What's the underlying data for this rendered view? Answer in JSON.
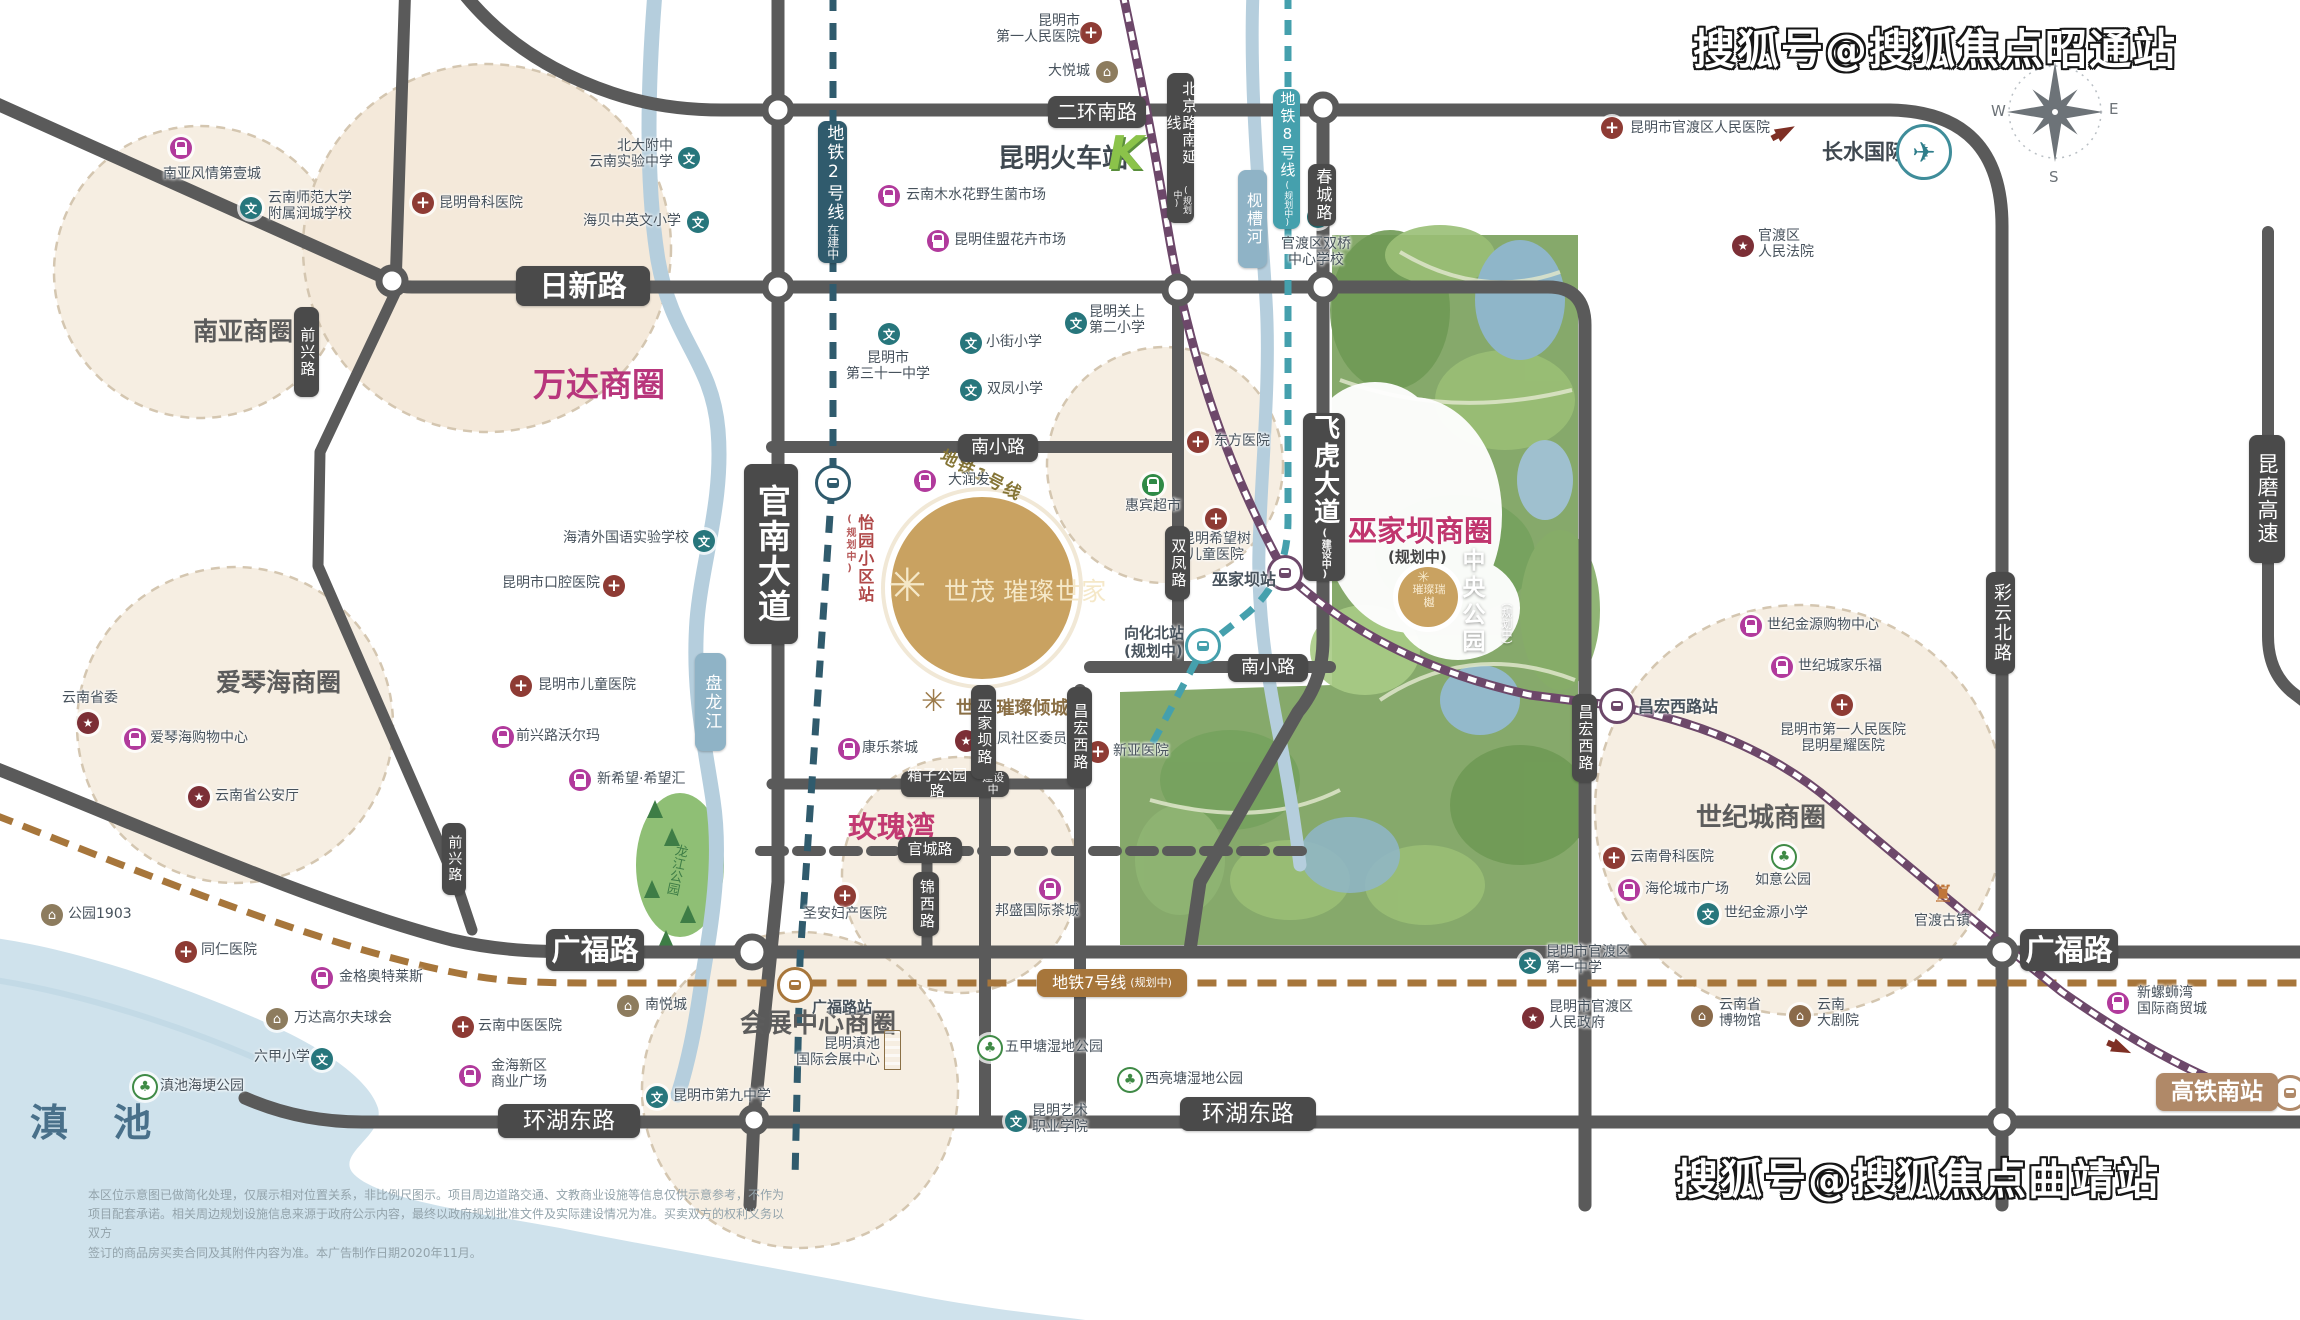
{
  "watermark_top": "搜狐号@搜狐焦点昭通站",
  "watermark_bottom": "搜狐号@搜狐焦点曲靖站",
  "lake_label": "滇 池",
  "compass": {
    "w": "W",
    "e": "E",
    "s": "S"
  },
  "airport": {
    "name": "长水国际机场"
  },
  "kstation": {
    "name": "昆明火车站",
    "logo": "K"
  },
  "project": {
    "flower": "✳",
    "main": "世茂 璀璨世家",
    "sub": "世茂 璀璨倾城",
    "small": "璀璨瑞樾"
  },
  "central_park": {
    "name": "中央公园",
    "status": "（规划中）"
  },
  "wujiaba": {
    "name": "巫家坝商圈",
    "status": "(规划中)"
  },
  "line1_label": "地铁1号线",
  "longjiang_park": "龙江公园",
  "disclaimer": {
    "l1": "本区位示意图已做简化处理，仅展示相对位置关系，非比例尺图示。项目周边道路交通、文教商业设施等信息仅供示意参考，不作为",
    "l2": "项目配套承诺。相关周边规划设施信息来源于政府公示内容，最终以政府规划批准文件及实际建设情况为准。买卖双方的权利义务以双方",
    "l3": "签订的商品房买卖合同及其附件内容为准。本广告制作日期2020年11月。"
  },
  "pills": [
    {
      "t": "日新路",
      "x": 516,
      "y": 266,
      "w": 134,
      "h": 40,
      "fs": 29,
      "bold": 1
    },
    {
      "t": "二环南路",
      "x": 1048,
      "y": 96,
      "w": 98,
      "h": 32,
      "fs": 20
    },
    {
      "t": "广福路",
      "x": 546,
      "y": 929,
      "w": 98,
      "h": 42,
      "fs": 29,
      "bold": 1
    },
    {
      "t": "广福路",
      "x": 2020,
      "y": 929,
      "w": 98,
      "h": 42,
      "fs": 29,
      "bold": 1
    },
    {
      "t": "环湖东路",
      "x": 498,
      "y": 1104,
      "w": 142,
      "h": 34,
      "fs": 23
    },
    {
      "t": "环湖东路",
      "x": 1180,
      "y": 1097,
      "w": 136,
      "h": 34,
      "fs": 23
    },
    {
      "t": "南小路",
      "x": 958,
      "y": 434,
      "w": 80,
      "h": 28,
      "fs": 18
    },
    {
      "t": "南小路",
      "x": 1228,
      "y": 654,
      "w": 80,
      "h": 28,
      "fs": 18
    },
    {
      "t": "箱子公园路",
      "x": 901,
      "y": 771,
      "w": 108,
      "h": 26,
      "fs": 15,
      "sub2": "建设中"
    },
    {
      "t": "官城路",
      "x": 898,
      "y": 837,
      "w": 64,
      "h": 26,
      "fs": 15
    },
    {
      "t": "锦西路",
      "x": 913,
      "y": 872,
      "w": 26,
      "h": 64,
      "fs": 15,
      "v": 1
    },
    {
      "t": "官南大道",
      "x": 744,
      "y": 464,
      "w": 54,
      "h": 180,
      "fs": 33,
      "v": 1,
      "bold": 1
    },
    {
      "t": "飞虎大道",
      "x": 1303,
      "y": 413,
      "w": 42,
      "h": 168,
      "fs": 26,
      "v": 1,
      "bold": 1,
      "sub": "(建设中)",
      "subFs": 10
    },
    {
      "t": "双凤路",
      "x": 1165,
      "y": 526,
      "w": 25,
      "h": 74,
      "fs": 15,
      "v": 1
    },
    {
      "t": "巫家坝路",
      "x": 971,
      "y": 685,
      "w": 25,
      "h": 94,
      "fs": 15,
      "v": 1
    },
    {
      "t": "昌宏西路",
      "x": 1067,
      "y": 687,
      "w": 25,
      "h": 100,
      "fs": 15,
      "v": 1
    },
    {
      "t": "昌宏西路",
      "x": 1572,
      "y": 694,
      "w": 25,
      "h": 88,
      "fs": 15,
      "v": 1
    },
    {
      "t": "彩云北路",
      "x": 1986,
      "y": 572,
      "w": 29,
      "h": 102,
      "fs": 18,
      "v": 1
    },
    {
      "t": "前兴路",
      "x": 294,
      "y": 307,
      "w": 25,
      "h": 90,
      "fs": 15,
      "v": 1
    },
    {
      "t": "前兴路",
      "x": 442,
      "y": 823,
      "w": 24,
      "h": 72,
      "fs": 14,
      "v": 1
    },
    {
      "t": "春城路",
      "x": 1308,
      "y": 164,
      "w": 28,
      "h": 62,
      "fs": 16,
      "v": 1
    },
    {
      "t": "昆磨高速",
      "x": 2249,
      "y": 435,
      "w": 36,
      "h": 128,
      "fs": 21,
      "v": 1
    },
    {
      "t": "北京路南延线",
      "x": 1167,
      "y": 73,
      "w": 27,
      "h": 150,
      "fs": 15,
      "v": 1,
      "sub": "(规划中)",
      "subFs": 9
    },
    {
      "t": "地铁2号线",
      "x": 818,
      "y": 121,
      "w": 29,
      "h": 142,
      "fs": 17,
      "v": 1,
      "bg": "#305b6d",
      "sub": "在建中",
      "subFs": 12
    },
    {
      "t": "地铁8号线",
      "x": 1273,
      "y": 89,
      "w": 27,
      "h": 140,
      "fs": 15,
      "v": 1,
      "bg": "#45a0ad",
      "sub": "(规划中)",
      "subFs": 9
    },
    {
      "t": "地铁7号线",
      "x": 1037,
      "y": 969,
      "w": 150,
      "h": 28,
      "fs": 16,
      "bg": "#a7763b",
      "sub2": "(规划中)"
    },
    {
      "t": "盘龙江",
      "x": 695,
      "y": 653,
      "w": 31,
      "h": 98,
      "fs": 17,
      "v": 1,
      "bg": "#8fb3c6"
    },
    {
      "t": "枧槽河",
      "x": 1238,
      "y": 170,
      "w": 29,
      "h": 98,
      "fs": 16,
      "v": 1,
      "bg": "#8fb3c6"
    },
    {
      "t": "高铁南站",
      "x": 2156,
      "y": 1073,
      "w": 122,
      "h": 38,
      "fs": 23,
      "bg": "#b08968",
      "bold": 1
    }
  ],
  "areas": [
    {
      "t": "南亚商圈",
      "x": 193,
      "y": 312,
      "fs": 25,
      "c": "#5c5c5c"
    },
    {
      "t": "万达商圈",
      "x": 533,
      "y": 358,
      "fs": 33,
      "c": "#b8367c"
    },
    {
      "t": "爱琴海商圈",
      "x": 216,
      "y": 663,
      "fs": 25,
      "c": "#5c5c5c"
    },
    {
      "t": "玫瑰湾",
      "x": 848,
      "y": 804,
      "fs": 29,
      "c": "#c23a72"
    },
    {
      "t": "世纪城商圈",
      "x": 1696,
      "y": 797,
      "fs": 26,
      "c": "#5c5c5c"
    },
    {
      "t": "会展中心商圈",
      "x": 740,
      "y": 1003,
      "fs": 26,
      "c": "#5c5c5c"
    },
    {
      "t": "昆明火车站",
      "x": 998,
      "y": 138,
      "fs": 26,
      "c": "#3f4850"
    }
  ],
  "pois": [
    {
      "k": "shop",
      "ix": 181,
      "iy": 148,
      "t": "南亚风情第壹城",
      "lx": 163,
      "ly": 166
    },
    {
      "k": "school",
      "ix": 251,
      "iy": 208,
      "t": "云南师范大学\n附属润城学校",
      "lx": 268,
      "ly": 190
    },
    {
      "k": "hospital",
      "ix": 423,
      "iy": 203,
      "t": "昆明骨科医院",
      "lx": 439,
      "ly": 195
    },
    {
      "k": "school",
      "ix": 689,
      "iy": 158,
      "t": "北大附中\n云南实验中学",
      "lx": 673,
      "ly": 138,
      "a": "tr"
    },
    {
      "k": "school",
      "ix": 698,
      "iy": 222,
      "t": "海贝中英文小学",
      "lx": 681,
      "ly": 213,
      "a": "tr"
    },
    {
      "k": "hospital",
      "ix": 1091,
      "iy": 33,
      "t": "昆明市\n第一人民医院",
      "lx": 1080,
      "ly": 13,
      "a": "tr"
    },
    {
      "k": "bldg",
      "ix": 1107,
      "iy": 72,
      "t": "大悦城",
      "lx": 1090,
      "ly": 63,
      "a": "tr"
    },
    {
      "k": "shop",
      "ix": 889,
      "iy": 196,
      "t": "云南木水花野生菌市场",
      "lx": 906,
      "ly": 187
    },
    {
      "k": "shop",
      "ix": 938,
      "iy": 241,
      "t": "昆明佳盟花卉市场",
      "lx": 954,
      "ly": 232
    },
    {
      "k": "hospital",
      "ix": 1612,
      "iy": 128,
      "t": "昆明市官渡区人民医院",
      "lx": 1630,
      "ly": 120
    },
    {
      "k": "gov",
      "ix": 1743,
      "iy": 246,
      "t": "官渡区\n人民法院",
      "lx": 1758,
      "ly": 228
    },
    {
      "k": "school",
      "ix": 1318,
      "iy": 217,
      "t": "官渡区双桥\n中心学校",
      "lx": 1316,
      "ly": 236,
      "a": "tc"
    },
    {
      "k": "school",
      "ix": 889,
      "iy": 334,
      "t": "昆明市\n第三十一中学",
      "lx": 888,
      "ly": 350,
      "a": "tc"
    },
    {
      "k": "school",
      "ix": 971,
      "iy": 343,
      "t": "小街小学",
      "lx": 986,
      "ly": 334
    },
    {
      "k": "school",
      "ix": 971,
      "iy": 390,
      "t": "双凤小学",
      "lx": 987,
      "ly": 381
    },
    {
      "k": "school",
      "ix": 1076,
      "iy": 323,
      "t": "昆明关上\n第二小学",
      "lx": 1089,
      "ly": 304
    },
    {
      "k": "school",
      "ix": 704,
      "iy": 541,
      "t": "海清外国语实验学校",
      "lx": 689,
      "ly": 530,
      "a": "tr"
    },
    {
      "k": "hospital",
      "ix": 614,
      "iy": 586,
      "t": "昆明市口腔医院",
      "lx": 600,
      "ly": 575,
      "a": "tr"
    },
    {
      "k": "hospital",
      "ix": 1198,
      "iy": 442,
      "t": "东方医院",
      "lx": 1214,
      "ly": 433
    },
    {
      "k": "hospital",
      "ix": 1216,
      "iy": 519,
      "t": "昆明希望树\n儿童医院",
      "lx": 1216,
      "ly": 531,
      "a": "tc"
    },
    {
      "k": "shopg",
      "ix": 1153,
      "iy": 485,
      "t": "惠宾超市",
      "lx": 1153,
      "ly": 498,
      "a": "tc"
    },
    {
      "k": "shop",
      "ix": 925,
      "iy": 481,
      "t": "大润发",
      "lx": 948,
      "ly": 472
    },
    {
      "k": "hospital",
      "ix": 521,
      "iy": 686,
      "t": "昆明市儿童医院",
      "lx": 538,
      "ly": 677
    },
    {
      "k": "shop",
      "ix": 503,
      "iy": 737,
      "t": "前兴路沃尔玛",
      "lx": 516,
      "ly": 728
    },
    {
      "k": "shop",
      "ix": 580,
      "iy": 780,
      "t": "新希望·希望汇",
      "lx": 597,
      "ly": 771
    },
    {
      "k": "gov",
      "ix": 966,
      "iy": 741,
      "t": "双凤社区委员会",
      "lx": 983,
      "ly": 731
    },
    {
      "k": "hospital",
      "ix": 1098,
      "iy": 752,
      "t": "新亚医院",
      "lx": 1113,
      "ly": 743
    },
    {
      "k": "shop",
      "ix": 849,
      "iy": 749,
      "t": "康乐茶城",
      "lx": 862,
      "ly": 740
    },
    {
      "k": "hospital",
      "ix": 845,
      "iy": 896,
      "t": "圣安妇产医院",
      "lx": 845,
      "ly": 906,
      "a": "tc"
    },
    {
      "k": "shop",
      "ix": 1050,
      "iy": 889,
      "t": "邦盛国际茶城",
      "lx": 1037,
      "ly": 903,
      "a": "tc"
    },
    {
      "k": "gov",
      "ix": 88,
      "iy": 723,
      "t": "云南省委",
      "lx": 62,
      "ly": 690
    },
    {
      "k": "shop",
      "ix": 135,
      "iy": 739,
      "t": "爱琴海购物中心",
      "lx": 150,
      "ly": 730
    },
    {
      "k": "gov",
      "ix": 199,
      "iy": 797,
      "t": "云南省公安厅",
      "lx": 215,
      "ly": 788
    },
    {
      "k": "bldg",
      "ix": 52,
      "iy": 915,
      "t": "公园1903",
      "lx": 68,
      "ly": 906
    },
    {
      "k": "hospital",
      "ix": 186,
      "iy": 952,
      "t": "同仁医院",
      "lx": 201,
      "ly": 942
    },
    {
      "k": "shop",
      "ix": 322,
      "iy": 978,
      "t": "金格奥特莱斯",
      "lx": 339,
      "ly": 969
    },
    {
      "k": "bldg",
      "ix": 277,
      "iy": 1019,
      "t": "万达高尔夫球会",
      "lx": 294,
      "ly": 1010
    },
    {
      "k": "school",
      "ix": 322,
      "iy": 1059,
      "t": "六甲小学",
      "lx": 310,
      "ly": 1049,
      "a": "tr"
    },
    {
      "k": "park",
      "ix": 145,
      "iy": 1087,
      "t": "滇池海埂公园",
      "lx": 160,
      "ly": 1078
    },
    {
      "k": "hospital",
      "ix": 463,
      "iy": 1027,
      "t": "云南中医医院",
      "lx": 478,
      "ly": 1018
    },
    {
      "k": "shop",
      "ix": 470,
      "iy": 1076,
      "t": "金海新区\n商业广场",
      "lx": 491,
      "ly": 1058
    },
    {
      "k": "bldg",
      "ix": 628,
      "iy": 1006,
      "t": "南悦城",
      "lx": 645,
      "ly": 997
    },
    {
      "k": "school",
      "ix": 657,
      "iy": 1097,
      "t": "昆明市第九中学",
      "lx": 673,
      "ly": 1088
    },
    {
      "k": "expo",
      "ix": 884,
      "iy": 1036,
      "t": "昆明滇池\n国际会展中心",
      "lx": 880,
      "ly": 1036,
      "a": "tr"
    },
    {
      "k": "park",
      "ix": 990,
      "iy": 1048,
      "t": "五甲塘湿地公园",
      "lx": 1005,
      "ly": 1039
    },
    {
      "k": "park",
      "ix": 1130,
      "iy": 1080,
      "t": "西亮塘湿地公园",
      "lx": 1145,
      "ly": 1071
    },
    {
      "k": "school",
      "ix": 1016,
      "iy": 1121,
      "t": "昆明艺术\n职业学院",
      "lx": 1032,
      "ly": 1103
    },
    {
      "k": "school",
      "ix": 1530,
      "iy": 963,
      "t": "昆明市官渡区\n第一中学",
      "lx": 1546,
      "ly": 944
    },
    {
      "k": "gov",
      "ix": 1533,
      "iy": 1018,
      "t": "昆明市官渡区\n人民政府",
      "lx": 1549,
      "ly": 999
    },
    {
      "k": "museum",
      "ix": 1702,
      "iy": 1016,
      "t": "云南省\n博物馆",
      "lx": 1719,
      "ly": 997
    },
    {
      "k": "museum",
      "ix": 1800,
      "iy": 1016,
      "t": "云南\n大剧院",
      "lx": 1817,
      "ly": 997
    },
    {
      "k": "hospital",
      "ix": 1842,
      "iy": 705,
      "t": "昆明市第一人民医院\n昆明星耀医院",
      "lx": 1843,
      "ly": 722,
      "a": "tc"
    },
    {
      "k": "shop",
      "ix": 1751,
      "iy": 626,
      "t": "世纪金源购物中心",
      "lx": 1767,
      "ly": 617
    },
    {
      "k": "shop",
      "ix": 1782,
      "iy": 667,
      "t": "世纪城家乐福",
      "lx": 1798,
      "ly": 658
    },
    {
      "k": "hospital",
      "ix": 1614,
      "iy": 858,
      "t": "云南骨科医院",
      "lx": 1630,
      "ly": 849
    },
    {
      "k": "shop",
      "ix": 1629,
      "iy": 890,
      "t": "海伦城市广场",
      "lx": 1645,
      "ly": 881
    },
    {
      "k": "park",
      "ix": 1784,
      "iy": 857,
      "t": "如意公园",
      "lx": 1783,
      "ly": 872,
      "a": "tc"
    },
    {
      "k": "school",
      "ix": 1708,
      "iy": 914,
      "t": "世纪金源小学",
      "lx": 1724,
      "ly": 905
    },
    {
      "k": "temple",
      "ix": 1943,
      "iy": 894,
      "t": "官渡古镇",
      "lx": 1942,
      "ly": 913,
      "a": "tc"
    },
    {
      "k": "shop",
      "ix": 2118,
      "iy": 1003,
      "t": "新螺蛳湾\n国际商贸城",
      "lx": 2137,
      "ly": 985
    }
  ],
  "stations": [
    {
      "x": 833,
      "y": 483,
      "c": "#305b6d",
      "lt": "怡园小区站",
      "lx": 843,
      "ly": 514,
      "lfs": 16,
      "lc": "#b04848",
      "lv": 1,
      "lsub": "(规划中)"
    },
    {
      "x": 795,
      "y": 985,
      "c": "#a7763b",
      "lt": "广福路站",
      "lx": 812,
      "ly": 998,
      "lfs": 15,
      "lc": "#47525c"
    },
    {
      "x": 1285,
      "y": 573,
      "c": "#6d486a",
      "lt": "巫家坝站",
      "lx": 1212,
      "ly": 570,
      "lfs": 16,
      "lc": "#47525c"
    },
    {
      "x": 1617,
      "y": 706,
      "c": "#6d486a",
      "lt": "昌宏西路站",
      "lx": 1638,
      "ly": 697,
      "lfs": 16,
      "lc": "#47525c"
    },
    {
      "x": 1203,
      "y": 646,
      "c": "#45a0ad",
      "lt": "向化北站\n(规划中)",
      "lx": 1124,
      "ly": 624,
      "lfs": 15,
      "lc": "#47525c"
    },
    {
      "x": 2290,
      "y": 1093,
      "c": "#b08968"
    }
  ]
}
